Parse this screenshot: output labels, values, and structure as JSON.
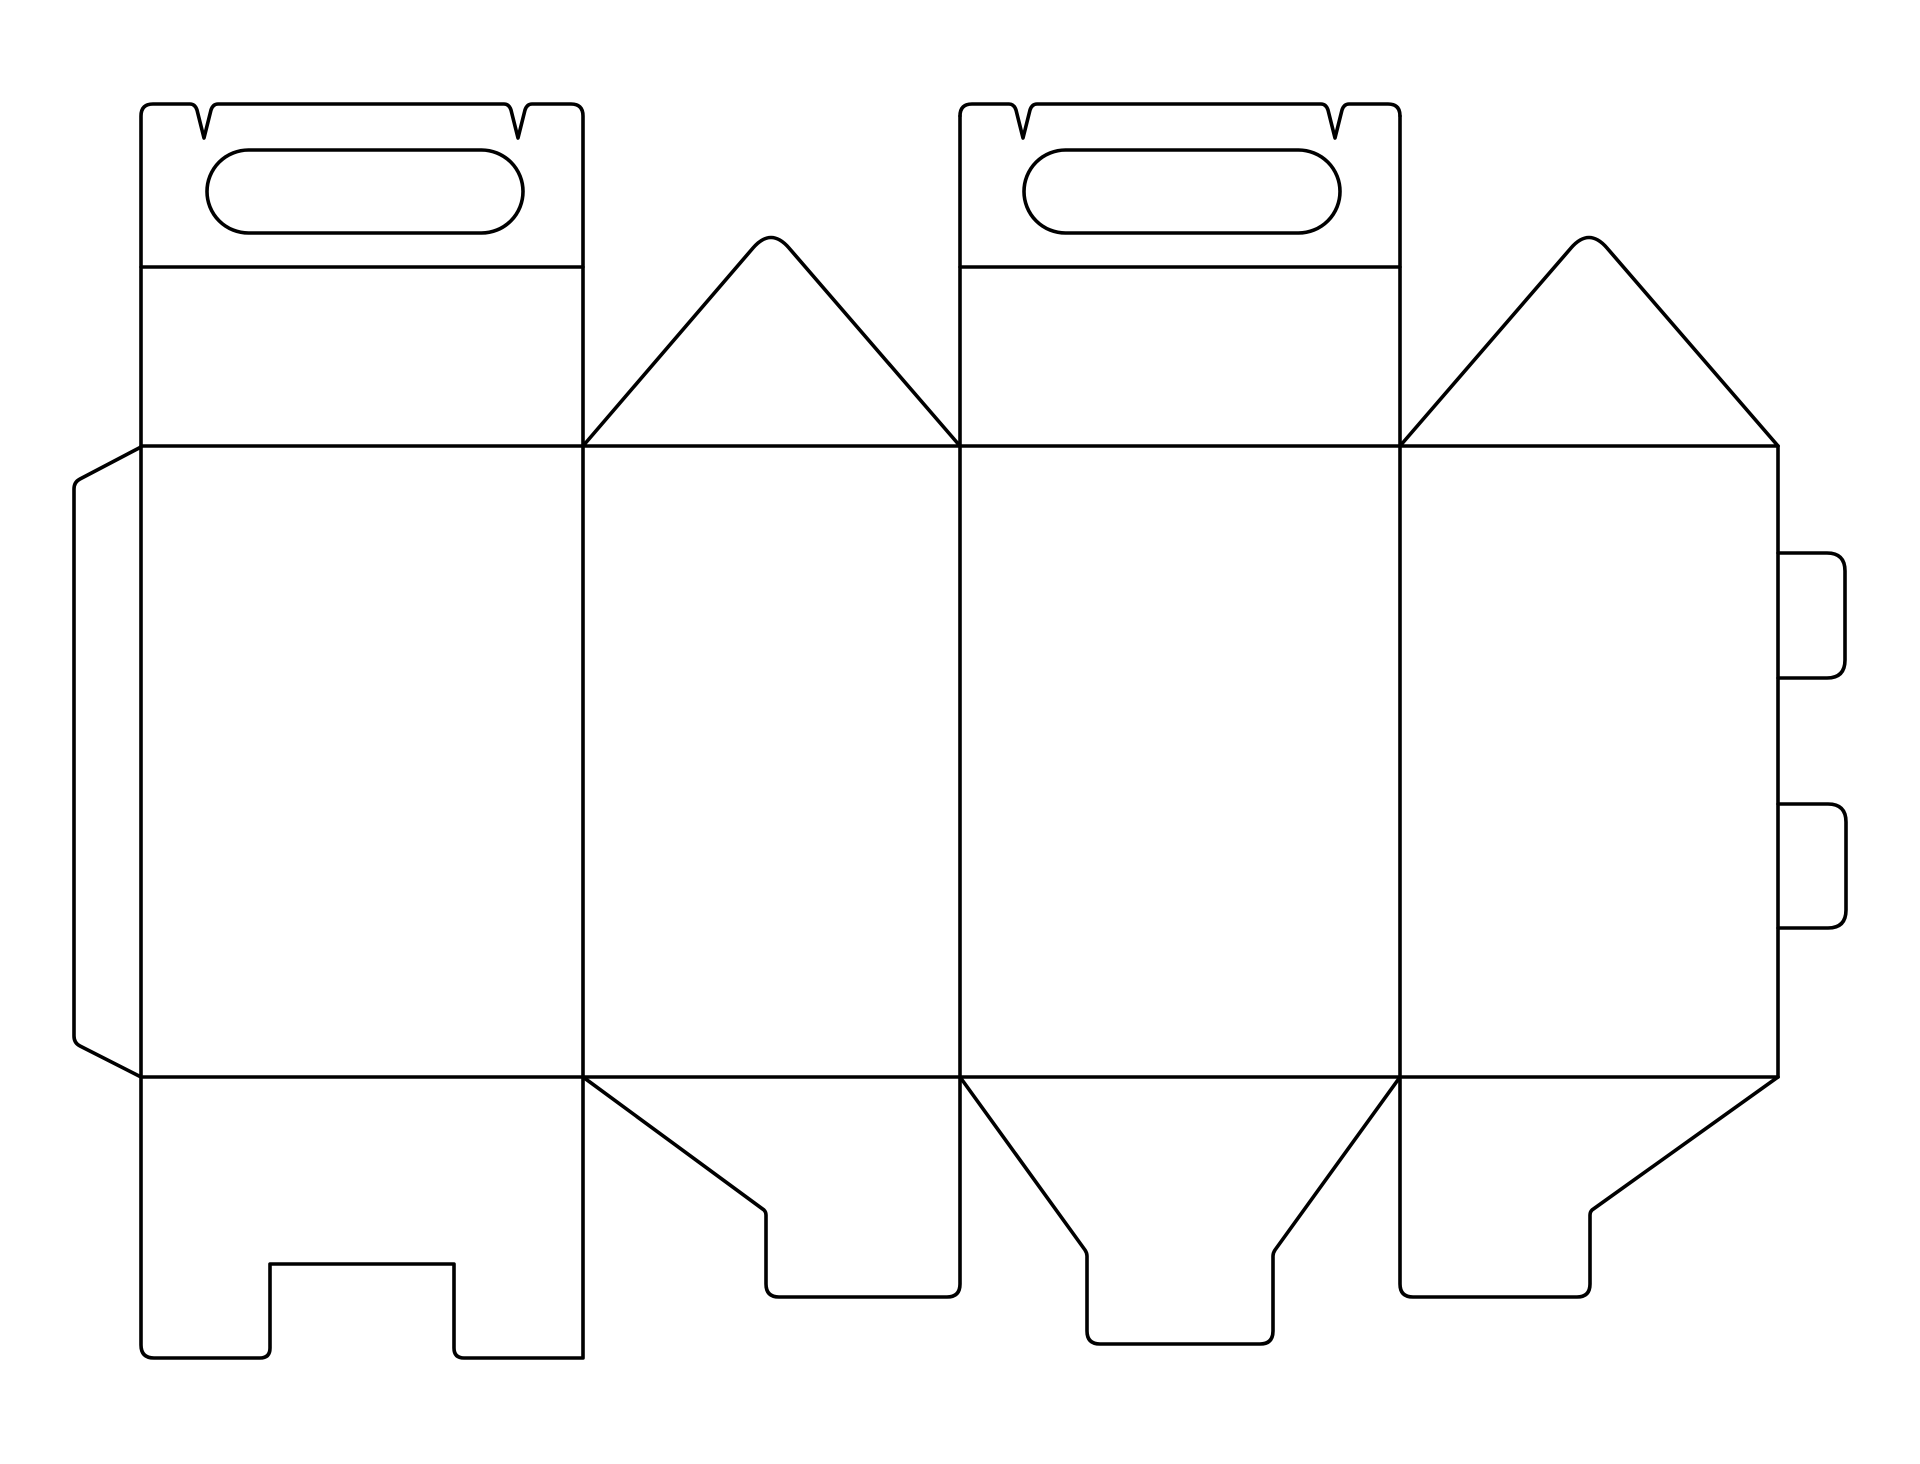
{
  "meta": {
    "description": "Die-cut template (dieline) of a gable carry-handle box, black outline on white"
  },
  "diagram": {
    "canvas": {
      "width": 1920,
      "height": 1464,
      "background": "#ffffff"
    },
    "stroke": {
      "color": "#000000",
      "width": 3.6,
      "linecap": "round",
      "linejoin": "round"
    },
    "paths": [
      {
        "name": "panel1-outline-with-handle-top-and-notched-bottom-flap",
        "d": "M 153,104 L 190,104 Q 195,104 197,110 L 204,138 L 211,110 Q 213,104 218,104 L 504,104 Q 509,104 511,110 L 518,138 L 525,110 Q 527,104 532,104 L 571,104 Q 583,104 583,116 L 583,1358 L 464,1358 Q 454,1358 454,1348 L 454,1264 L 270,1264 L 270,1348 Q 270,1358 260,1358 L 154,1358 Q 141,1358 141,1345 L 141,116 Q 141,104 153,104 Z"
      },
      {
        "name": "panel1-handle-hole",
        "d": "M 248.5,150 L 481.5,150 A 41.5,41.5 0 0 1 481.5,233 L 248.5,233 A 41.5,41.5 0 0 1 248.5,150 Z"
      },
      {
        "name": "panel1-handle-fold-line",
        "d": "M 141,267 L 583,267"
      },
      {
        "name": "glue-flap-left",
        "d": "M 141,447 L 80,479 Q 74,482 74,489 L 74,1036 Q 74,1043 80,1046 L 141,1077"
      },
      {
        "name": "top-fold-line",
        "d": "M 141,446 L 1778,446"
      },
      {
        "name": "bottom-fold-line",
        "d": "M 141,1077 L 1778,1077"
      },
      {
        "name": "panel2-gable-triangle",
        "d": "M 583,446 L 753,248 Q 771,227 789,248 L 960,446"
      },
      {
        "name": "panel2-bottom-flap",
        "d": "M 583,1077 L 764,1210 Q 766,1212 766,1215 L 766,1284 Q 766,1297 779,1297 L 947,1297 Q 960,1297 960,1284 L 960,1077"
      },
      {
        "name": "panel2-panel3-divider",
        "d": "M 960,116 L 960,1077"
      },
      {
        "name": "panel3-handle-top-edge",
        "d": "M 960,116 Q 960,104 972,104 L 1009,104 Q 1014,104 1016,110 L 1023,138 L 1030,110 Q 1032,104 1037,104 L 1321,104 Q 1326,104 1328,110 L 1335,138 L 1342,110 Q 1344,104 1349,104 L 1388,104 Q 1400,104 1400,116"
      },
      {
        "name": "panel3-handle-hole",
        "d": "M 1065.5,150 L 1298.5,150 A 41.5,41.5 0 0 1 1298.5,233 L 1065.5,233 A 41.5,41.5 0 0 1 1065.5,150 Z"
      },
      {
        "name": "panel3-handle-fold-line",
        "d": "M 960,267 L 1400,267"
      },
      {
        "name": "panel3-bottom-flap-funnel",
        "d": "M 960,1077 L 1085,1250 Q 1087,1253 1087,1256 L 1087,1331 Q 1087,1344 1100,1344 L 1260,1344 Q 1273,1344 1273,1331 L 1273,1256 Q 1273,1253 1275,1250 L 1400,1077"
      },
      {
        "name": "panel3-panel4-divider",
        "d": "M 1400,116 L 1400,1077"
      },
      {
        "name": "panel4-gable-triangle",
        "d": "M 1400,446 L 1571,248 Q 1589,227 1607,248 L 1778,446"
      },
      {
        "name": "panel4-right-edge",
        "d": "M 1778,446 L 1778,1077"
      },
      {
        "name": "panel4-bottom-flap",
        "d": "M 1400,1077 L 1400,1284 Q 1400,1297 1413,1297 L 1577,1297 Q 1590,1297 1590,1284 L 1590,1215 Q 1590,1212 1592,1210 L 1778,1077"
      },
      {
        "name": "side-tab-top",
        "d": "M 1778,553 L 1827,553 Q 1845,553 1845,571 L 1845,660 Q 1845,678 1827,678 L 1778,678"
      },
      {
        "name": "side-tab-bottom",
        "d": "M 1778,804 L 1828,804 Q 1846,804 1846,822 L 1846,910 Q 1846,928 1828,928 L 1778,928"
      }
    ]
  }
}
